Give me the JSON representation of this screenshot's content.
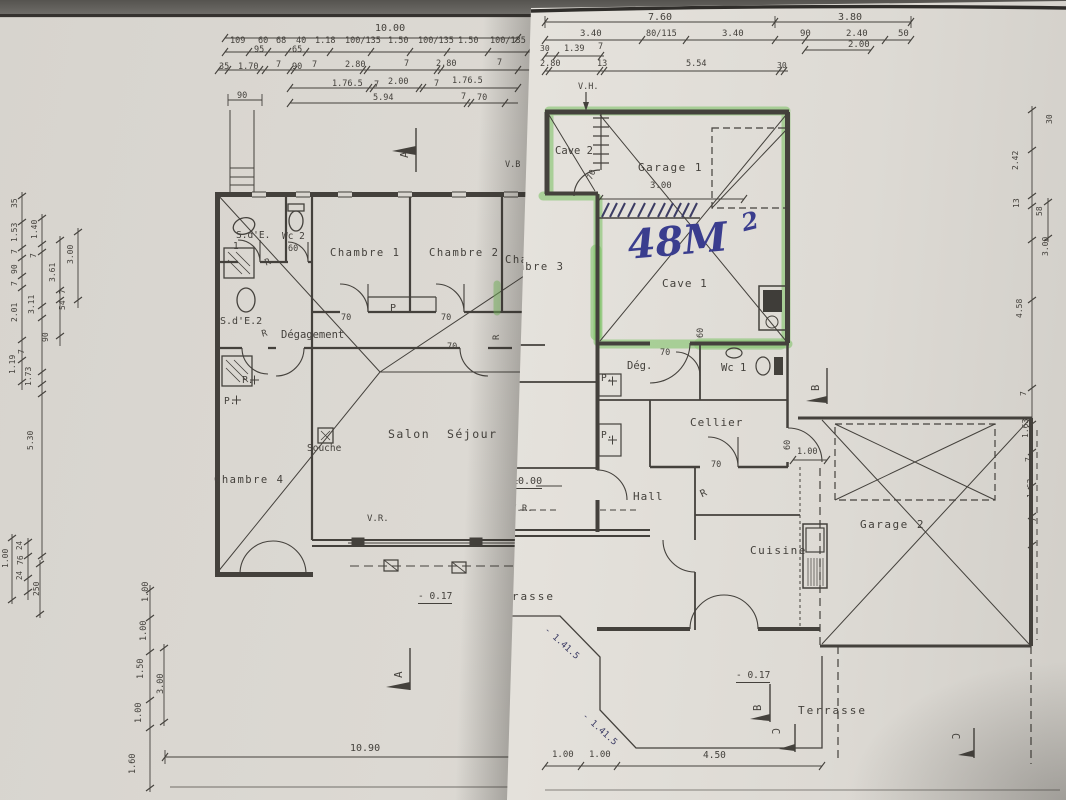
{
  "colors": {
    "ink": "#44413c",
    "pen": "#3c3c64",
    "blue": "#3a3d8e",
    "green": "rgba(121,193,96,0.55)"
  },
  "left_sheet": {
    "name": "ground-floor-plan-sheet",
    "labels": [
      {
        "n": "dim-overall",
        "t": "10.00",
        "x": 375,
        "y": 24,
        "s": 10
      },
      {
        "n": "dim",
        "t": "109",
        "x": 230,
        "y": 37,
        "s": 8.5
      },
      {
        "n": "dim",
        "t": "60",
        "x": 258,
        "y": 37,
        "s": 8.5
      },
      {
        "n": "dim",
        "t": "95",
        "x": 254,
        "y": 46,
        "s": 8.5
      },
      {
        "n": "dim",
        "t": "68",
        "x": 276,
        "y": 37,
        "s": 8.5
      },
      {
        "n": "dim",
        "t": "40",
        "x": 296,
        "y": 37,
        "s": 8.5
      },
      {
        "n": "dim",
        "t": "65",
        "x": 292,
        "y": 46,
        "s": 8.5
      },
      {
        "n": "dim",
        "t": "1.18",
        "x": 315,
        "y": 37,
        "s": 8.5
      },
      {
        "n": "dim",
        "t": "100/135",
        "x": 345,
        "y": 37,
        "s": 8.5
      },
      {
        "n": "dim",
        "t": "1.50",
        "x": 388,
        "y": 37,
        "s": 8.5
      },
      {
        "n": "dim",
        "t": "100/135",
        "x": 418,
        "y": 37,
        "s": 8.5
      },
      {
        "n": "dim",
        "t": "1.50",
        "x": 458,
        "y": 37,
        "s": 8.5
      },
      {
        "n": "dim",
        "t": "100/135",
        "x": 490,
        "y": 37,
        "s": 8.5
      },
      {
        "n": "dim",
        "t": "35",
        "x": 219,
        "y": 63,
        "s": 8.5
      },
      {
        "n": "dim",
        "t": "1.70",
        "x": 238,
        "y": 63,
        "s": 8.5
      },
      {
        "n": "dim",
        "t": "7",
        "x": 276,
        "y": 61,
        "s": 8.5
      },
      {
        "n": "dim",
        "t": "90",
        "x": 292,
        "y": 63,
        "s": 8.5
      },
      {
        "n": "dim",
        "t": "7",
        "x": 312,
        "y": 61,
        "s": 8.5
      },
      {
        "n": "dim",
        "t": "2.80",
        "x": 345,
        "y": 61,
        "s": 8.5
      },
      {
        "n": "dim",
        "t": "7",
        "x": 404,
        "y": 60,
        "s": 8.5
      },
      {
        "n": "dim",
        "t": "2.80",
        "x": 436,
        "y": 60,
        "s": 8.5
      },
      {
        "n": "dim",
        "t": "7",
        "x": 497,
        "y": 59,
        "s": 8.5
      },
      {
        "n": "dim",
        "t": "90",
        "x": 237,
        "y": 92,
        "s": 8.5
      },
      {
        "n": "dim",
        "t": "1.76.5",
        "x": 332,
        "y": 80,
        "s": 8.5
      },
      {
        "n": "dim",
        "t": "7",
        "x": 374,
        "y": 81,
        "s": 8.5
      },
      {
        "n": "dim",
        "t": "2.00",
        "x": 388,
        "y": 78,
        "s": 8.5
      },
      {
        "n": "dim",
        "t": "7",
        "x": 434,
        "y": 80,
        "s": 8.5
      },
      {
        "n": "dim",
        "t": "1.76.5",
        "x": 452,
        "y": 77,
        "s": 8.5
      },
      {
        "n": "dim",
        "t": "5.94",
        "x": 373,
        "y": 94,
        "s": 8.5
      },
      {
        "n": "dim",
        "t": "7",
        "x": 461,
        "y": 93,
        "s": 8.5
      },
      {
        "n": "dim",
        "t": "70",
        "x": 477,
        "y": 94,
        "s": 8.5
      },
      {
        "n": "room-sde1",
        "t": "S.d'E.",
        "x": 236,
        "y": 231,
        "s": 9.5
      },
      {
        "n": "room-sde1",
        "t": "1",
        "x": 233,
        "y": 242,
        "s": 9.5
      },
      {
        "n": "room-wc2",
        "t": "Wc 2",
        "x": 282,
        "y": 232,
        "s": 9.5
      },
      {
        "n": "dim-door",
        "t": "60",
        "x": 288,
        "y": 245,
        "s": 8.5
      },
      {
        "n": "room-chambre1",
        "t": "Chambre 1",
        "x": 330,
        "y": 248,
        "s": 10.5,
        "ls": 1.5
      },
      {
        "n": "room-chambre2",
        "t": "Chambre 2",
        "x": 429,
        "y": 248,
        "s": 10.5,
        "ls": 1.5
      },
      {
        "n": "room-chambre3",
        "t": "Chambre 3",
        "x": 505,
        "y": 255,
        "s": 10.5,
        "ls": 1.5
      },
      {
        "n": "note-r",
        "t": "R",
        "x": 264,
        "y": 260,
        "s": 9,
        "r": -20
      },
      {
        "n": "room-sde2",
        "t": "S.d'E.2",
        "x": 220,
        "y": 317,
        "s": 10
      },
      {
        "n": "note-r",
        "t": "R",
        "x": 261,
        "y": 331,
        "s": 9,
        "r": -15
      },
      {
        "n": "room-degagement",
        "t": "Dégagement",
        "x": 281,
        "y": 330,
        "s": 10.5
      },
      {
        "n": "dim-door",
        "t": "70",
        "x": 341,
        "y": 314,
        "s": 8.5
      },
      {
        "n": "note-placard",
        "t": "P",
        "x": 390,
        "y": 304,
        "s": 10
      },
      {
        "n": "dim-door",
        "t": "70",
        "x": 441,
        "y": 314,
        "s": 8.5
      },
      {
        "n": "dim-door",
        "t": "70",
        "x": 447,
        "y": 343,
        "s": 8.5
      },
      {
        "n": "note-r",
        "t": "R",
        "x": 493,
        "y": 340,
        "s": 9,
        "r": -90
      },
      {
        "n": "note-placard",
        "t": "P.",
        "x": 242,
        "y": 376,
        "s": 9.5
      },
      {
        "n": "note-placard",
        "t": "P.",
        "x": 224,
        "y": 397,
        "s": 9.5
      },
      {
        "n": "note-souche",
        "t": "Souche",
        "x": 307,
        "y": 444,
        "s": 9.5
      },
      {
        "n": "room-salon",
        "t": "Salon  Séjour",
        "x": 388,
        "y": 429,
        "s": 11.5,
        "ls": 1.5
      },
      {
        "n": "room-chambre4",
        "t": "Chambre 4",
        "x": 214,
        "y": 475,
        "s": 10.5,
        "ls": 1.5
      },
      {
        "n": "note-vr",
        "t": "V.R.",
        "x": 367,
        "y": 515,
        "s": 9
      },
      {
        "n": "level",
        "t": "- 0.17",
        "x": 418,
        "y": 592,
        "s": 9.5,
        "u": true
      },
      {
        "n": "dim-bottom",
        "t": "10.90",
        "x": 350,
        "y": 744,
        "s": 10
      },
      {
        "n": "section-a",
        "t": "A",
        "x": 399,
        "y": 158,
        "s": 11,
        "r": -90
      },
      {
        "n": "section-a",
        "t": "A",
        "x": 393,
        "y": 678,
        "s": 11,
        "r": -90
      },
      {
        "n": "note-vb",
        "t": "V.B",
        "x": 505,
        "y": 161,
        "s": 8.5
      },
      {
        "n": "dim-v",
        "t": "35",
        "x": 11,
        "y": 208,
        "s": 8,
        "r": -90
      },
      {
        "n": "dim-v",
        "t": "1.53",
        "x": 11,
        "y": 242,
        "s": 8,
        "r": -90
      },
      {
        "n": "dim-v",
        "t": "7",
        "x": 11,
        "y": 254,
        "s": 8,
        "r": -90
      },
      {
        "n": "dim-v",
        "t": "90",
        "x": 11,
        "y": 274,
        "s": 8,
        "r": -90
      },
      {
        "n": "dim-v",
        "t": "7",
        "x": 11,
        "y": 286,
        "s": 8,
        "r": -90
      },
      {
        "n": "dim-v",
        "t": "2.01",
        "x": 11,
        "y": 322,
        "s": 8,
        "r": -90
      },
      {
        "n": "dim-v",
        "t": "1.19",
        "x": 9,
        "y": 374,
        "s": 8,
        "r": -90
      },
      {
        "n": "dim-v",
        "t": "1.73",
        "x": 25,
        "y": 386,
        "s": 8,
        "r": -90
      },
      {
        "n": "dim-v",
        "t": "1.40",
        "x": 31,
        "y": 239,
        "s": 8,
        "r": -90
      },
      {
        "n": "dim-v",
        "t": "7",
        "x": 30,
        "y": 258,
        "s": 8,
        "r": -90
      },
      {
        "n": "dim-v",
        "t": "3.11",
        "x": 28,
        "y": 314,
        "s": 8,
        "r": -90
      },
      {
        "n": "dim-v",
        "t": "3.61",
        "x": 49,
        "y": 282,
        "s": 8,
        "r": -90
      },
      {
        "n": "dim-v",
        "t": "7",
        "x": 59,
        "y": 294,
        "s": 8,
        "r": -90
      },
      {
        "n": "dim-v",
        "t": "54",
        "x": 59,
        "y": 310,
        "s": 8,
        "r": -90
      },
      {
        "n": "dim-v",
        "t": "90",
        "x": 42,
        "y": 342,
        "s": 8,
        "r": -90
      },
      {
        "n": "dim-v",
        "t": "7",
        "x": 18,
        "y": 354,
        "s": 8,
        "r": -90
      },
      {
        "n": "dim-v",
        "t": "3.00",
        "x": 67,
        "y": 264,
        "s": 8,
        "r": -90
      },
      {
        "n": "dim-v",
        "t": "5.30",
        "x": 27,
        "y": 450,
        "s": 8,
        "r": -90
      },
      {
        "n": "dim-v",
        "t": "24",
        "x": 16,
        "y": 550,
        "s": 7.5,
        "r": -90
      },
      {
        "n": "dim-v",
        "t": "76",
        "x": 17,
        "y": 565,
        "s": 8,
        "r": -90
      },
      {
        "n": "dim-v",
        "t": "24",
        "x": 16,
        "y": 580,
        "s": 7.5,
        "r": -90
      },
      {
        "n": "dim-v",
        "t": "1.00",
        "x": 2,
        "y": 568,
        "s": 8,
        "r": -90
      },
      {
        "n": "dim-v",
        "t": "250",
        "x": 33,
        "y": 596,
        "s": 8,
        "r": -90
      },
      {
        "n": "dim-v",
        "t": "1.00",
        "x": 142,
        "y": 602,
        "s": 8.5,
        "r": -90
      },
      {
        "n": "dim-v",
        "t": "1.00",
        "x": 140,
        "y": 641,
        "s": 8.5,
        "r": -90
      },
      {
        "n": "dim-v",
        "t": "1.50",
        "x": 137,
        "y": 679,
        "s": 8.5,
        "r": -90
      },
      {
        "n": "dim-v",
        "t": "3.00",
        "x": 157,
        "y": 694,
        "s": 8.5,
        "r": -90
      },
      {
        "n": "dim-v",
        "t": "1.00",
        "x": 135,
        "y": 723,
        "s": 8.5,
        "r": -90
      },
      {
        "n": "dim-v",
        "t": "1.60",
        "x": 129,
        "y": 774,
        "s": 8.5,
        "r": -90
      }
    ]
  },
  "right_sheet": {
    "name": "basement-plan-sheet",
    "highlight_area_note": "48M2 highlighted zone: Cave 2 + Garage 1 + Cave 1",
    "labels": [
      {
        "n": "dim-overall",
        "t": "7.60",
        "x": 648,
        "y": 13,
        "s": 10
      },
      {
        "n": "dim-overall",
        "t": "3.80",
        "x": 838,
        "y": 13,
        "s": 10
      },
      {
        "n": "dim",
        "t": "3.40",
        "x": 580,
        "y": 30,
        "s": 9
      },
      {
        "n": "dim",
        "t": "80/115",
        "x": 646,
        "y": 30,
        "s": 8.5
      },
      {
        "n": "dim",
        "t": "3.40",
        "x": 722,
        "y": 30,
        "s": 9
      },
      {
        "n": "dim",
        "t": "90",
        "x": 800,
        "y": 30,
        "s": 9
      },
      {
        "n": "dim",
        "t": "2.40",
        "x": 846,
        "y": 30,
        "s": 9
      },
      {
        "n": "dim",
        "t": "50",
        "x": 898,
        "y": 30,
        "s": 9
      },
      {
        "n": "dim",
        "t": "2.00",
        "x": 848,
        "y": 41,
        "s": 9
      },
      {
        "n": "dim",
        "t": "30",
        "x": 540,
        "y": 45,
        "s": 8
      },
      {
        "n": "dim",
        "t": "1.39",
        "x": 564,
        "y": 45,
        "s": 8.5
      },
      {
        "n": "dim",
        "t": "7",
        "x": 598,
        "y": 43,
        "s": 8.5
      },
      {
        "n": "dim",
        "t": "2.80",
        "x": 540,
        "y": 60,
        "s": 8.5
      },
      {
        "n": "dim",
        "t": "13",
        "x": 597,
        "y": 60,
        "s": 8.5
      },
      {
        "n": "dim",
        "t": "5.54",
        "x": 686,
        "y": 60,
        "s": 8.5
      },
      {
        "n": "dim",
        "t": "30",
        "x": 777,
        "y": 62,
        "s": 8
      },
      {
        "n": "note-vh",
        "t": "V.H.",
        "x": 578,
        "y": 83,
        "s": 8.5
      },
      {
        "n": "room-cave2",
        "t": "Cave 2",
        "x": 555,
        "y": 146,
        "s": 10.5
      },
      {
        "n": "dim-door",
        "t": "70",
        "x": 586,
        "y": 178,
        "s": 8.5,
        "r": -65
      },
      {
        "n": "room-garage1",
        "t": "Garage 1",
        "x": 638,
        "y": 162,
        "s": 11,
        "ls": 1.5
      },
      {
        "n": "dim",
        "t": "3.00",
        "x": 650,
        "y": 182,
        "s": 9
      },
      {
        "n": "handwritten-area",
        "t": "48M",
        "x": 626,
        "y": 226,
        "s": 40,
        "c": "blue",
        "r": -5,
        "f": "hand"
      },
      {
        "n": "handwritten-area-exp",
        "t": "2",
        "x": 739,
        "y": 212,
        "s": 24,
        "c": "blue",
        "r": -14,
        "f": "hand"
      },
      {
        "n": "room-cave1",
        "t": "Cave 1",
        "x": 662,
        "y": 278,
        "s": 11,
        "ls": 1
      },
      {
        "n": "room-chambre3-cut",
        "t": "Chambre 3",
        "x": 494,
        "y": 262,
        "s": 10.5,
        "ls": 1.5
      },
      {
        "n": "room-deg",
        "t": "Dég.",
        "x": 627,
        "y": 361,
        "s": 10.5
      },
      {
        "n": "dim-door",
        "t": "70",
        "x": 660,
        "y": 349,
        "s": 8.5
      },
      {
        "n": "dim-door",
        "t": "60",
        "x": 697,
        "y": 338,
        "s": 8.5,
        "r": -90
      },
      {
        "n": "room-wc1",
        "t": "Wc 1",
        "x": 721,
        "y": 363,
        "s": 10.5
      },
      {
        "n": "note-placard",
        "t": "P.",
        "x": 601,
        "y": 374,
        "s": 9.5
      },
      {
        "n": "note-placard",
        "t": "P.",
        "x": 601,
        "y": 431,
        "s": 9.5
      },
      {
        "n": "level-zero",
        "t": "±0.00",
        "x": 512,
        "y": 477,
        "s": 10,
        "u": true
      },
      {
        "n": "room-hall",
        "t": "Hall",
        "x": 633,
        "y": 491,
        "s": 11,
        "ls": 1
      },
      {
        "n": "note-vr",
        "t": "V.R.",
        "x": 511,
        "y": 505,
        "s": 9
      },
      {
        "n": "note-r",
        "t": "R",
        "x": 699,
        "y": 491,
        "s": 10,
        "r": -25
      },
      {
        "n": "room-cellier",
        "t": "Cellier",
        "x": 690,
        "y": 417,
        "s": 11,
        "ls": 1
      },
      {
        "n": "dim-door",
        "t": "70",
        "x": 711,
        "y": 461,
        "s": 8.5
      },
      {
        "n": "dim-door",
        "t": "60",
        "x": 784,
        "y": 450,
        "s": 8.5,
        "r": -90
      },
      {
        "n": "dim",
        "t": "1.00",
        "x": 797,
        "y": 448,
        "s": 8.5
      },
      {
        "n": "room-cuisine",
        "t": "Cuisine",
        "x": 750,
        "y": 545,
        "s": 11,
        "ls": 1.5
      },
      {
        "n": "room-garage2",
        "t": "Garage 2",
        "x": 860,
        "y": 519,
        "s": 11,
        "ls": 1.5
      },
      {
        "n": "section-b",
        "t": "B",
        "x": 811,
        "y": 391,
        "s": 10.5,
        "r": -90
      },
      {
        "n": "section-b",
        "t": "B",
        "x": 753,
        "y": 711,
        "s": 10.5,
        "r": -90
      },
      {
        "n": "level",
        "t": "- 0.17",
        "x": 736,
        "y": 671,
        "s": 9.5,
        "u": true
      },
      {
        "n": "room-terrasse",
        "t": "Terrasse",
        "x": 798,
        "y": 705,
        "s": 11,
        "ls": 2
      },
      {
        "n": "section-c",
        "t": "C",
        "x": 780,
        "y": 728,
        "s": 10.5,
        "r": 90
      },
      {
        "n": "section-c",
        "t": "C",
        "x": 960,
        "y": 733,
        "s": 10.5,
        "r": 90
      },
      {
        "n": "room-terrasse-cut",
        "t": "Terrasse",
        "x": 486,
        "y": 591,
        "s": 11,
        "ls": 2
      },
      {
        "n": "hand-level",
        "t": "- 1.41.5",
        "x": 548,
        "y": 626,
        "s": 9,
        "r": 42,
        "c": "pen"
      },
      {
        "n": "hand-level",
        "t": "- 1.41.5",
        "x": 586,
        "y": 712,
        "s": 9,
        "r": 42,
        "c": "pen"
      },
      {
        "n": "dim",
        "t": "1.00",
        "x": 552,
        "y": 751,
        "s": 9
      },
      {
        "n": "dim",
        "t": "1.00",
        "x": 589,
        "y": 751,
        "s": 9
      },
      {
        "n": "dim",
        "t": "4.50",
        "x": 703,
        "y": 751,
        "s": 9.5
      },
      {
        "n": "dim-v",
        "t": "30",
        "x": 1046,
        "y": 124,
        "s": 8,
        "r": -90
      },
      {
        "n": "dim-v",
        "t": "2.42",
        "x": 1012,
        "y": 170,
        "s": 8,
        "r": -90
      },
      {
        "n": "dim-v",
        "t": "13",
        "x": 1013,
        "y": 208,
        "s": 8,
        "r": -90
      },
      {
        "n": "dim-v",
        "t": "58",
        "x": 1036,
        "y": 216,
        "s": 8,
        "r": -90
      },
      {
        "n": "dim-v",
        "t": "3.00",
        "x": 1042,
        "y": 256,
        "s": 8,
        "r": -90
      },
      {
        "n": "dim-v",
        "t": "4.58",
        "x": 1016,
        "y": 318,
        "s": 8,
        "r": -90
      },
      {
        "n": "dim-v",
        "t": "7",
        "x": 1020,
        "y": 396,
        "s": 8,
        "r": -90
      },
      {
        "n": "dim-v",
        "t": "1.63",
        "x": 1022,
        "y": 438,
        "s": 8,
        "r": -90
      },
      {
        "n": "dim-v",
        "t": "7",
        "x": 1025,
        "y": 462,
        "s": 8,
        "r": -90
      },
      {
        "n": "dim-v",
        "t": "1.63",
        "x": 1027,
        "y": 498,
        "s": 8,
        "r": -90
      },
      {
        "n": "dim-v",
        "t": "7",
        "x": 1030,
        "y": 522,
        "s": 8,
        "r": -90
      }
    ]
  }
}
